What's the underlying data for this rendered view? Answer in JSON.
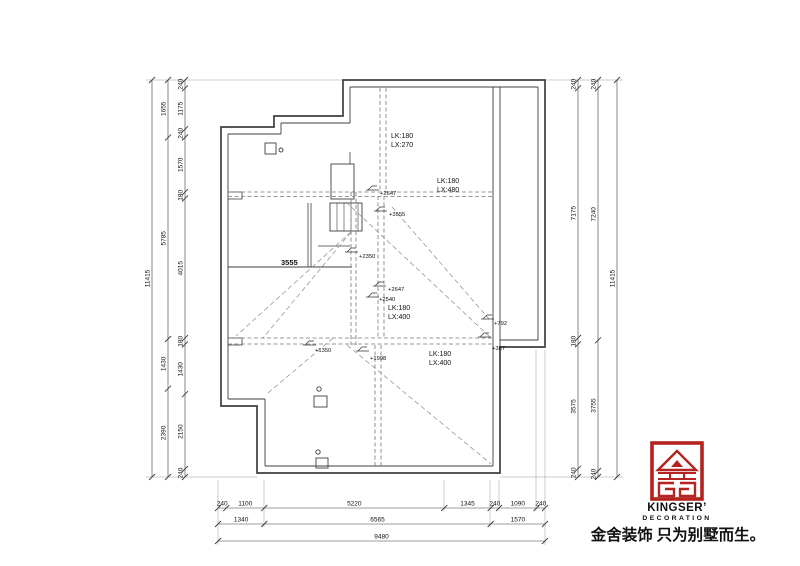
{
  "drawing_title": "basement floor plan",
  "dimensions": {
    "left_inner": [
      "240",
      "1175",
      "240",
      "1570",
      "180",
      "4015",
      "180",
      "1430",
      "2150",
      "240"
    ],
    "left_mid": [
      "1655",
      "5785",
      "1430",
      "2390"
    ],
    "left_total": [
      "11415"
    ],
    "right_inner": [
      "240",
      "7175",
      "180",
      "3575",
      "240"
    ],
    "right_mid": [
      "240",
      "7240",
      "3755",
      "240"
    ],
    "right_total": [
      "11415"
    ],
    "bottom_row1": [
      "240",
      "1100",
      "5220",
      "1345",
      "240",
      "1090",
      "240"
    ],
    "bottom_row2": [
      "1340",
      "6565",
      "1570"
    ],
    "bottom_total": [
      "9480"
    ]
  },
  "annotations": {
    "beam_labels": [
      {
        "x": 391,
        "y1": 138,
        "y2": 147,
        "line1": "LK:180",
        "line2": "LX:270"
      },
      {
        "x": 437,
        "y1": 183,
        "y2": 192,
        "line1": "LK:180",
        "line2": "LX:480"
      },
      {
        "x": 388,
        "y1": 310,
        "y2": 319,
        "line1": "LK:180",
        "line2": "LX:400"
      },
      {
        "x": 429,
        "y1": 356,
        "y2": 365,
        "line1": "LK:180",
        "line2": "LX:400"
      }
    ],
    "elevation_marks": [
      {
        "x": 366,
        "y": 190,
        "tx": 380,
        "ty": 195,
        "label": "+2647"
      },
      {
        "x": 374,
        "y": 211,
        "tx": 389,
        "ty": 216,
        "label": "+3555"
      },
      {
        "x": 345,
        "y": 252,
        "tx": 359,
        "ty": 258,
        "label": "+2350"
      },
      {
        "x": 373,
        "y": 286,
        "tx": 388,
        "ty": 291,
        "label": "+2647"
      },
      {
        "x": 366,
        "y": 297,
        "tx": 379,
        "ty": 301,
        "label": "+2540"
      },
      {
        "x": 481,
        "y": 319,
        "tx": 494,
        "ty": 325,
        "label": "+792"
      },
      {
        "x": 478,
        "y": 337,
        "tx": 492,
        "ty": 350,
        "label": "+387"
      },
      {
        "x": 303,
        "y": 345,
        "tx": 315,
        "ty": 352,
        "label": "+1350"
      },
      {
        "x": 356,
        "y": 351,
        "tx": 370,
        "ty": 360,
        "label": "+1998"
      }
    ],
    "wall_dim": {
      "label": "3555",
      "x": 281,
      "y": 265
    }
  },
  "watermark": {
    "text": "金舍装饰水印",
    "color": "#e2e2e2"
  },
  "logo": {
    "icon": "kingser-house-icon",
    "red": "#b4231f",
    "brand": "KINGSER’",
    "sub": "DECORATION",
    "tagline": "金舍装饰 只为别墅而生。"
  }
}
